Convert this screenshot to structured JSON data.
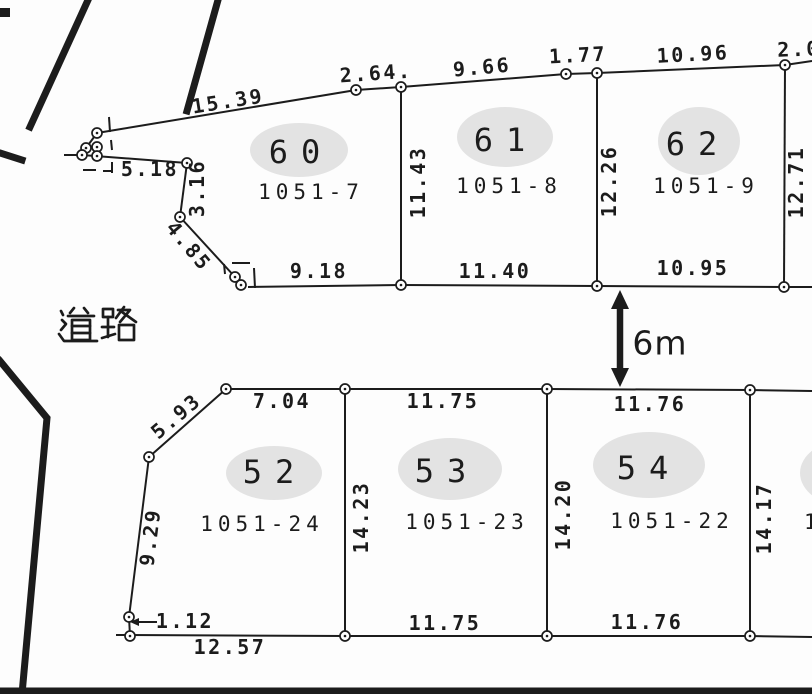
{
  "colors": {
    "ink": "#1c1c1c",
    "paper": "#fdfdfd",
    "ellipse_fill": "#e3e3e3"
  },
  "road_label": {
    "text": "道路",
    "center": [
      97,
      325
    ],
    "strokes": [
      [
        [
          74,
          308
        ],
        [
          70,
          313
        ]
      ],
      [
        [
          84,
          308
        ],
        [
          88,
          313
        ]
      ],
      [
        [
          68,
          316
        ],
        [
          94,
          316
        ]
      ],
      [
        [
          72,
          320
        ],
        [
          90,
          320
        ],
        [
          90,
          340
        ],
        [
          72,
          340
        ],
        [
          72,
          320
        ]
      ],
      [
        [
          72,
          326
        ],
        [
          90,
          326
        ]
      ],
      [
        [
          72,
          333
        ],
        [
          90,
          333
        ]
      ],
      [
        [
          61,
          311
        ],
        [
          63,
          315
        ]
      ],
      [
        [
          62,
          320
        ],
        [
          66,
          324
        ],
        [
          61,
          330
        ]
      ],
      [
        [
          59,
          334
        ],
        [
          64,
          341
        ],
        [
          97,
          341
        ]
      ],
      [
        [
          103,
          309
        ],
        [
          113,
          309
        ],
        [
          113,
          317
        ],
        [
          103,
          317
        ],
        [
          103,
          309
        ]
      ],
      [
        [
          108,
          317
        ],
        [
          108,
          337
        ]
      ],
      [
        [
          102,
          327
        ],
        [
          114,
          327
        ]
      ],
      [
        [
          102,
          338
        ],
        [
          115,
          334
        ]
      ],
      [
        [
          124,
          307
        ],
        [
          116,
          318
        ]
      ],
      [
        [
          118,
          310
        ],
        [
          130,
          310
        ],
        [
          120,
          322
        ]
      ],
      [
        [
          122,
          312
        ],
        [
          136,
          322
        ]
      ],
      [
        [
          119,
          325
        ],
        [
          134,
          325
        ],
        [
          134,
          340
        ],
        [
          119,
          340
        ],
        [
          119,
          325
        ]
      ]
    ]
  },
  "gap_arrow": {
    "label": "6m",
    "x": 620,
    "tip_top": 290,
    "tip_bottom": 387,
    "label_pos": [
      660,
      343
    ]
  },
  "plots": [
    {
      "number": "60",
      "lot": "1051-7",
      "ellipse": [
        299,
        150,
        49,
        27
      ],
      "num_pos": [
        301,
        152
      ],
      "lot_pos": [
        311,
        192
      ]
    },
    {
      "number": "61",
      "lot": "1051-8",
      "ellipse": [
        505,
        137,
        48,
        30
      ],
      "num_pos": [
        506,
        140
      ],
      "lot_pos": [
        509,
        186
      ]
    },
    {
      "number": "62",
      "lot": "1051-9",
      "ellipse": [
        699,
        141,
        41,
        34
      ],
      "num_pos": [
        698,
        144
      ],
      "lot_pos": [
        706,
        186
      ]
    },
    {
      "number": "52",
      "lot": "1051-24",
      "ellipse": [
        274,
        473,
        48,
        27
      ],
      "num_pos": [
        275,
        472
      ],
      "lot_pos": [
        262,
        524
      ]
    },
    {
      "number": "53",
      "lot": "1051-23",
      "ellipse": [
        450,
        469,
        52,
        31
      ],
      "num_pos": [
        447,
        471
      ],
      "lot_pos": [
        467,
        522
      ]
    },
    {
      "number": "54",
      "lot": "1051-22",
      "ellipse": [
        649,
        465,
        56,
        33
      ],
      "num_pos": [
        649,
        468
      ],
      "lot_pos": [
        672,
        521
      ]
    }
  ],
  "partial_plot": {
    "ellipse": [
      846,
      473,
      46,
      33
    ],
    "fragment": "1",
    "frag_pos": [
      804,
      529
    ]
  },
  "dims": [
    {
      "text": "15.39",
      "x": 228,
      "y": 101,
      "r": -9
    },
    {
      "text": "2.64.",
      "x": 376,
      "y": 73,
      "r": -4
    },
    {
      "text": "9.66",
      "x": 482,
      "y": 67,
      "r": -5
    },
    {
      "text": "1.77",
      "x": 578,
      "y": 55,
      "r": -3
    },
    {
      "text": "10.96",
      "x": 693,
      "y": 54,
      "r": -3
    },
    {
      "text": "2.0",
      "x": 799,
      "y": 49,
      "r": -2
    },
    {
      "text": "5.18",
      "x": 150,
      "y": 169,
      "r": 0
    },
    {
      "text": "3.16",
      "x": 197,
      "y": 188,
      "r": -90
    },
    {
      "text": "4.85",
      "x": 189,
      "y": 246,
      "r": 50
    },
    {
      "text": "9.18",
      "x": 319,
      "y": 271,
      "r": 0
    },
    {
      "text": "11.40",
      "x": 495,
      "y": 271,
      "r": 0
    },
    {
      "text": "10.95",
      "x": 693,
      "y": 268,
      "r": 0
    },
    {
      "text": "11.43",
      "x": 418,
      "y": 182,
      "r": -90
    },
    {
      "text": "12.26",
      "x": 609,
      "y": 181,
      "r": -90
    },
    {
      "text": "12.71",
      "x": 796,
      "y": 182,
      "r": -90
    },
    {
      "text": "5.93",
      "x": 176,
      "y": 416,
      "r": -40
    },
    {
      "text": "7.04",
      "x": 282,
      "y": 401,
      "r": 0
    },
    {
      "text": "11.75",
      "x": 443,
      "y": 401,
      "r": 0
    },
    {
      "text": "11.76",
      "x": 650,
      "y": 404,
      "r": 0
    },
    {
      "text": "9.29",
      "x": 150,
      "y": 537,
      "r": -83
    },
    {
      "text": "1.12",
      "x": 185,
      "y": 621,
      "r": 0
    },
    {
      "text": "12.57",
      "x": 230,
      "y": 647,
      "r": 0
    },
    {
      "text": "11.75",
      "x": 445,
      "y": 623,
      "r": 0
    },
    {
      "text": "11.76",
      "x": 647,
      "y": 622,
      "r": 0
    },
    {
      "text": "14.23",
      "x": 361,
      "y": 517,
      "r": -90
    },
    {
      "text": "14.20",
      "x": 563,
      "y": 514,
      "r": -90
    },
    {
      "text": "14.17",
      "x": 764,
      "y": 518,
      "r": -90
    }
  ],
  "thin_lines": [
    [
      97,
      133,
      356,
      90
    ],
    [
      356,
      90,
      401,
      87
    ],
    [
      401,
      87,
      566,
      74
    ],
    [
      566,
      74,
      597,
      73
    ],
    [
      597,
      73,
      785,
      65
    ],
    [
      785,
      65,
      812,
      61
    ],
    [
      64,
      155,
      82,
      155
    ],
    [
      82,
      155,
      187,
      163
    ],
    [
      187,
      163,
      180,
      217
    ],
    [
      180,
      217,
      235,
      277
    ],
    [
      97,
      133,
      86,
      148
    ],
    [
      248,
      287,
      401,
      285
    ],
    [
      401,
      285,
      597,
      286
    ],
    [
      597,
      286,
      784,
      287
    ],
    [
      784,
      287,
      812,
      287
    ],
    [
      401,
      87,
      401,
      285
    ],
    [
      597,
      73,
      597,
      286
    ],
    [
      785,
      65,
      784,
      287
    ],
    [
      226,
      389,
      345,
      389
    ],
    [
      345,
      389,
      547,
      389
    ],
    [
      547,
      389,
      750,
      390
    ],
    [
      750,
      390,
      812,
      391
    ],
    [
      226,
      389,
      149,
      457
    ],
    [
      149,
      457,
      129,
      617
    ],
    [
      129,
      617,
      130,
      636
    ],
    [
      116,
      635,
      345,
      636
    ],
    [
      345,
      636,
      547,
      636
    ],
    [
      547,
      636,
      750,
      636
    ],
    [
      750,
      636,
      812,
      637
    ],
    [
      345,
      389,
      345,
      636
    ],
    [
      547,
      389,
      547,
      636
    ],
    [
      750,
      390,
      750,
      636
    ],
    [
      133,
      622,
      157,
      622
    ]
  ],
  "leader_head": "130,622 139,618 139,626",
  "markers": [
    [
      97,
      133
    ],
    [
      86,
      148
    ],
    [
      97,
      147
    ],
    [
      82,
      155
    ],
    [
      97,
      156
    ],
    [
      187,
      163
    ],
    [
      180,
      217
    ],
    [
      235,
      277
    ],
    [
      241,
      285
    ],
    [
      356,
      90
    ],
    [
      401,
      87
    ],
    [
      566,
      74
    ],
    [
      597,
      73
    ],
    [
      785,
      65
    ],
    [
      401,
      285
    ],
    [
      597,
      286
    ],
    [
      784,
      287
    ],
    [
      226,
      389
    ],
    [
      345,
      389
    ],
    [
      547,
      389
    ],
    [
      750,
      390
    ],
    [
      149,
      457
    ],
    [
      129,
      617
    ],
    [
      130,
      636
    ],
    [
      345,
      636
    ],
    [
      547,
      636
    ],
    [
      750,
      636
    ]
  ],
  "dashes": [
    [
      109,
      117,
      110,
      132
    ],
    [
      111,
      140,
      112,
      150
    ],
    [
      112,
      162,
      112,
      173
    ],
    [
      83,
      170,
      96,
      170
    ],
    [
      103,
      171,
      113,
      171
    ],
    [
      224,
      264,
      225,
      274
    ],
    [
      232,
      263,
      250,
      263
    ],
    [
      254,
      268,
      255,
      288
    ]
  ],
  "thick_segments": [
    [
      [
        88,
        0
      ],
      [
        30,
        127
      ]
    ],
    [
      [
        0,
        153
      ],
      [
        22,
        160
      ]
    ],
    [
      [
        218,
        0
      ],
      [
        187,
        111
      ]
    ],
    [
      [
        0,
        361
      ],
      [
        47,
        418
      ],
      [
        22,
        694
      ]
    ],
    [
      [
        0,
        691
      ],
      [
        812,
        691
      ]
    ]
  ],
  "corner_block": {
    "x": 0,
    "y": 8,
    "w": 10,
    "h": 9
  }
}
